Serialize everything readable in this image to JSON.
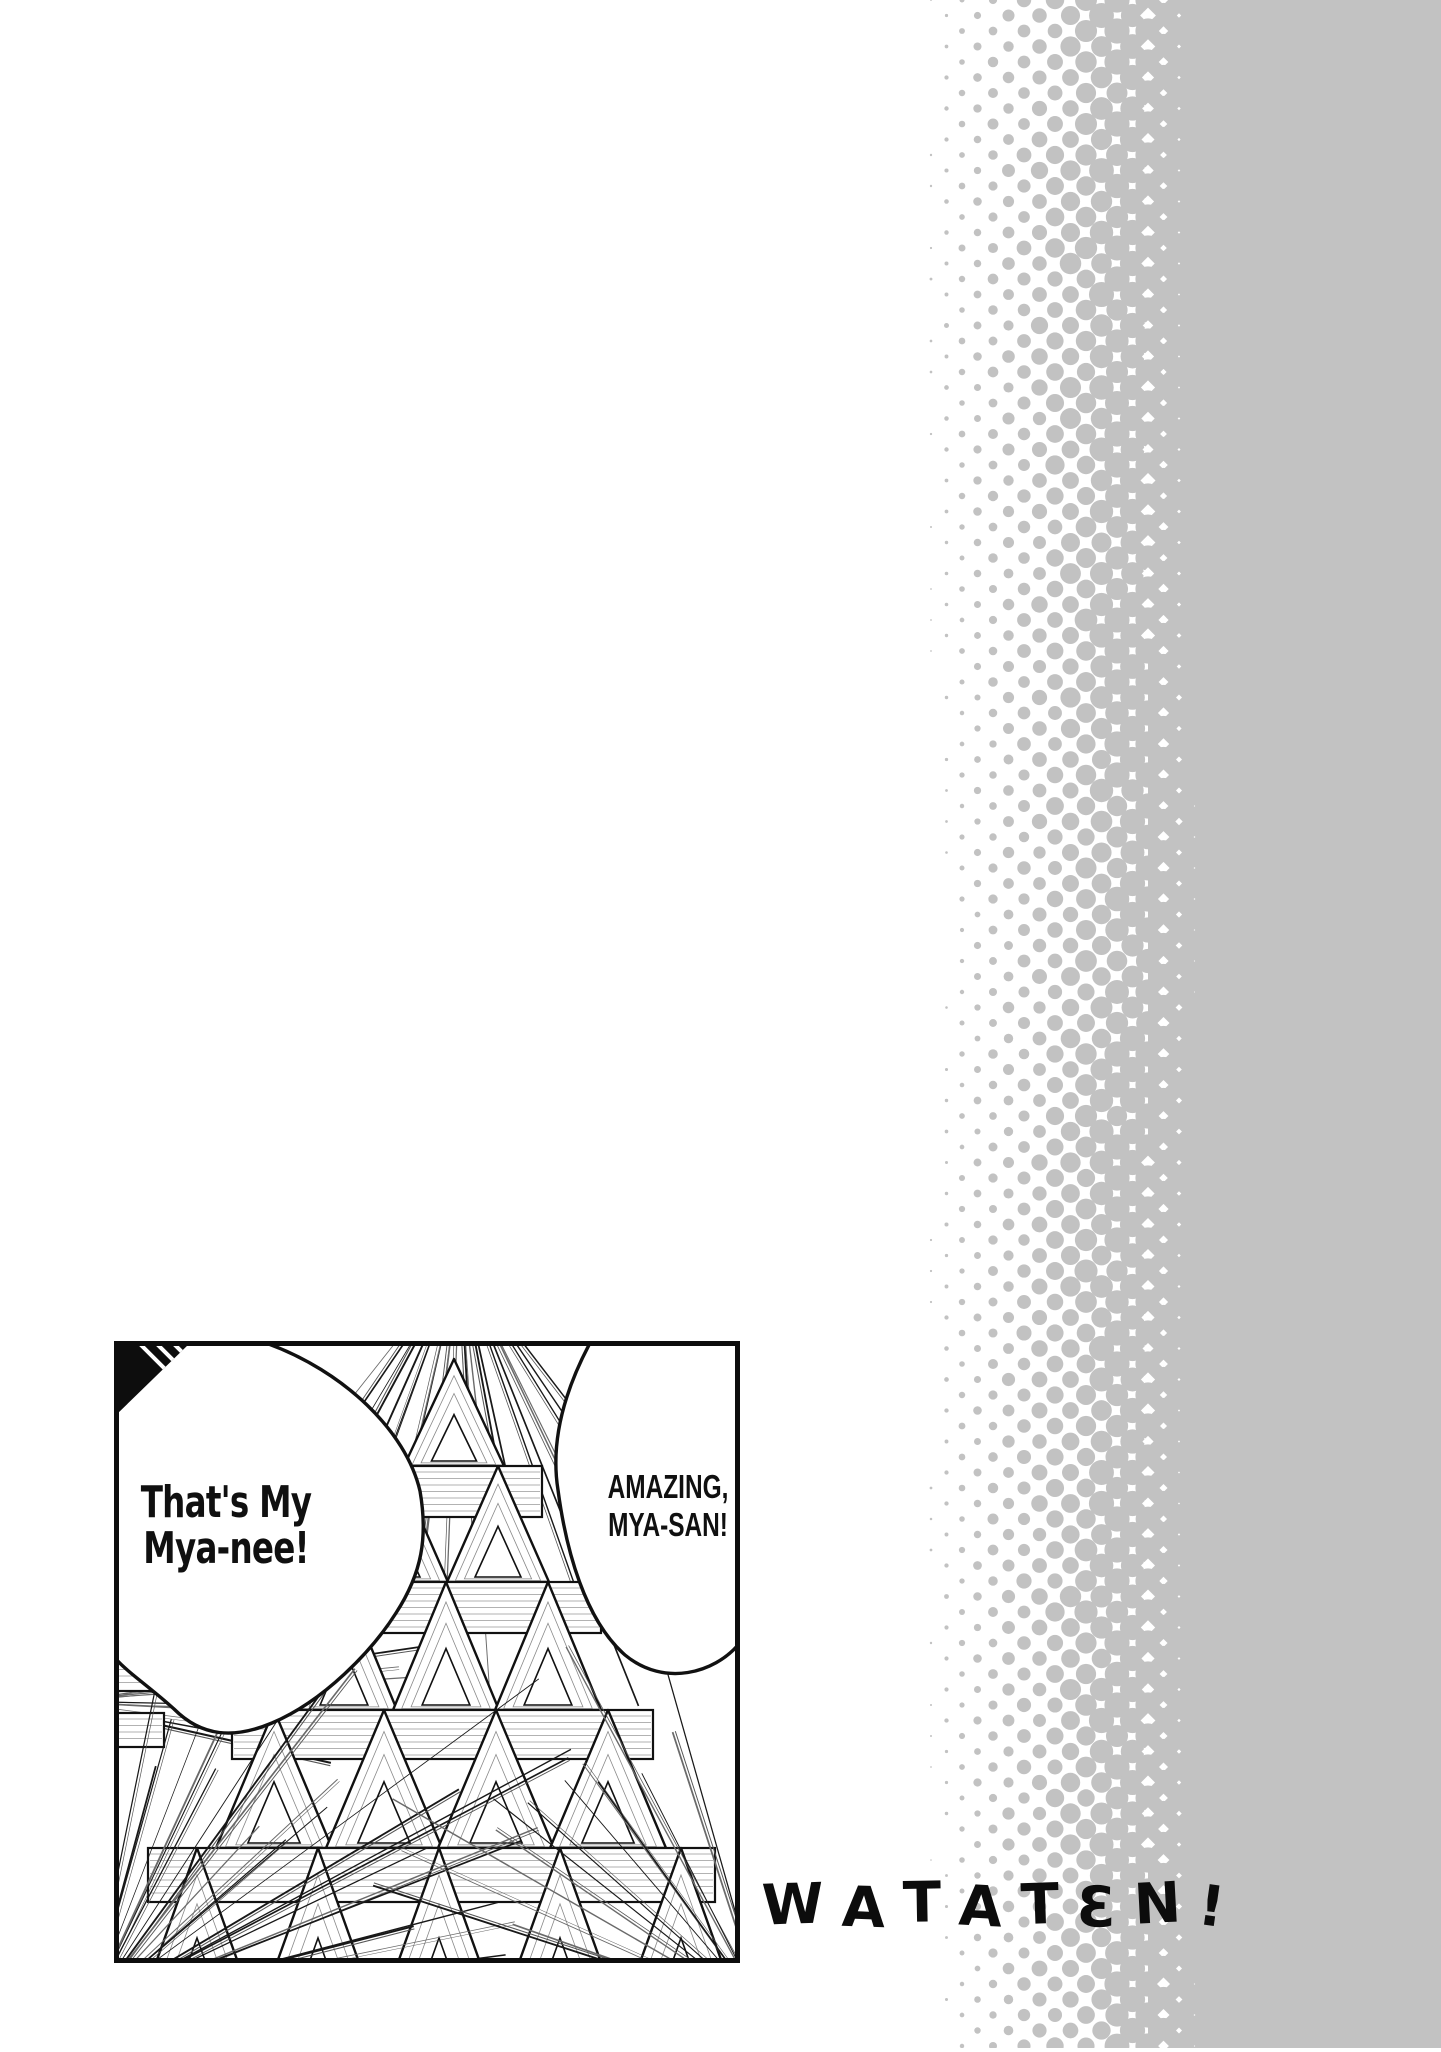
{
  "art": {
    "bubbles": {
      "left": {
        "line1": "That's My",
        "line2": "Mya-nee!"
      },
      "right": {
        "line1": "AMAZING,",
        "line2": "MYA-SAN!"
      }
    },
    "logo_text": "WATATEN!",
    "colors": {
      "halftone_gray": "#c2c2c2",
      "ink": "#111111",
      "paper": "#ffffff",
      "logo_ink": "#0c0c0c"
    }
  }
}
